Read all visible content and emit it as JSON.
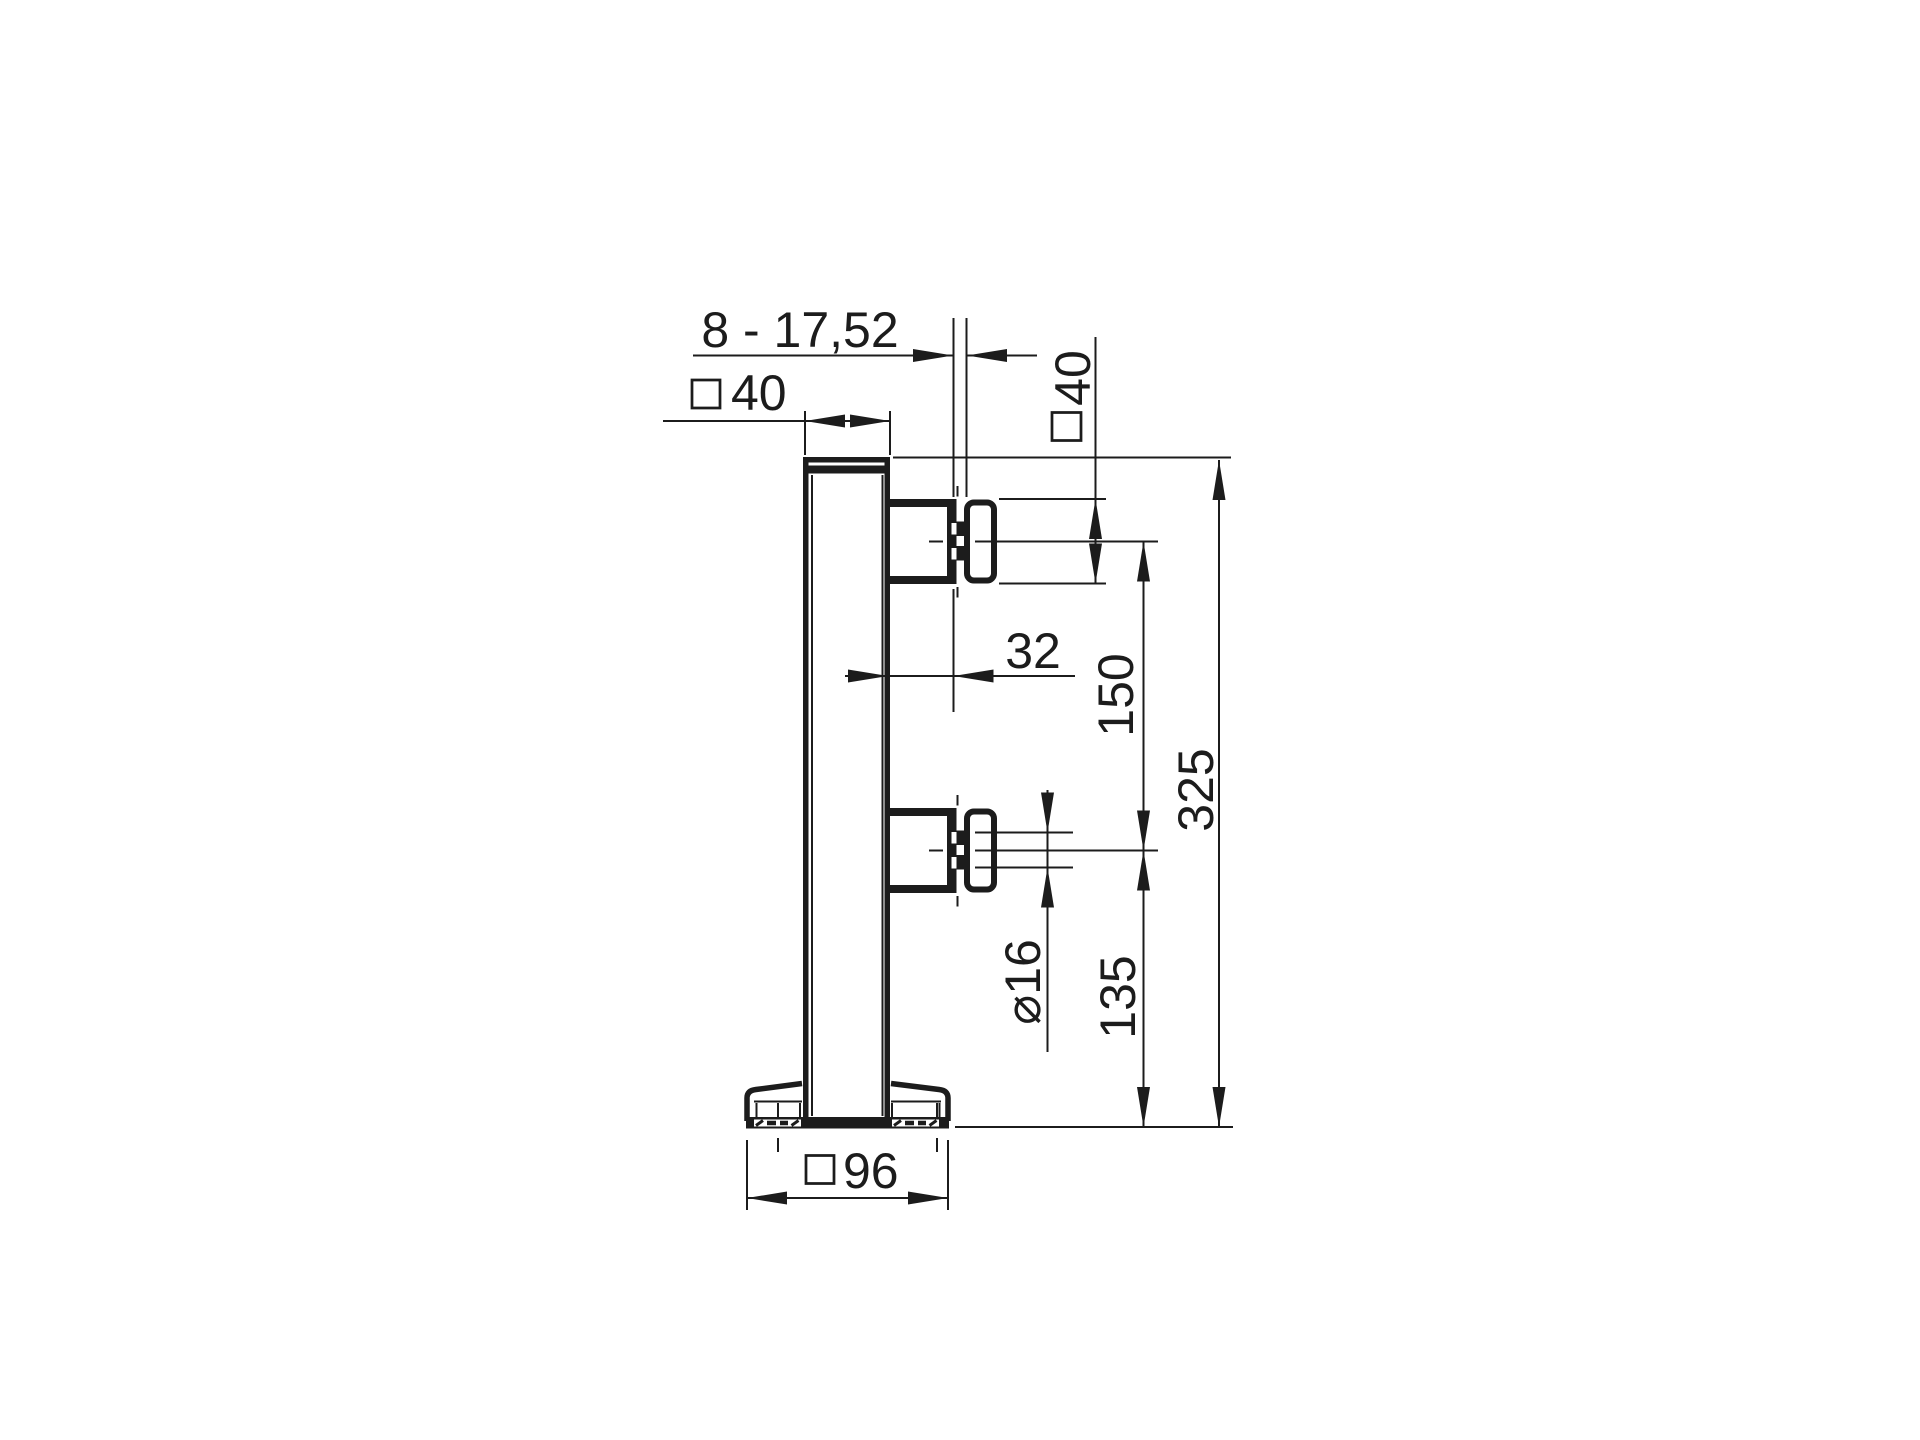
{
  "drawing": {
    "view": "side view technical drawing of glass railing post with two glass clamps and base plate",
    "units_note": ""
  },
  "labels": {
    "glass_thickness_range": "8 - 17,52",
    "post_section": "40",
    "clamp_section": "40",
    "glass_offset": "32",
    "clamp_center_distance": "150",
    "overall_height": "325",
    "connector_diameter": "⌀16",
    "lower_clamp_center_height": "135",
    "base_plate_width": "96"
  },
  "symbols": {
    "square_section": "□",
    "diameter": "⌀"
  },
  "colors": {
    "ink": "#1c1c1c",
    "background": "#ffffff"
  }
}
